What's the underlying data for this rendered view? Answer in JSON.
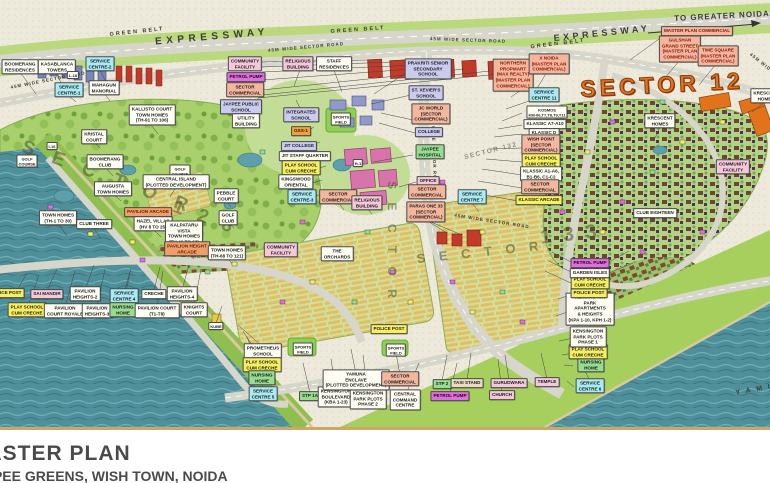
{
  "title": {
    "line1": "MASTER PLAN",
    "line2": "JAYPEE GREENS, WISH TOWN, NOIDA"
  },
  "palette": {
    "paper": "#eeeadb",
    "water": "#4e8f99",
    "golf_green": "#a9d06c",
    "road": "#d6d6ca",
    "green_belt": "#b9d97c",
    "commercial_orange": "#e0731c",
    "label_cyan": "#a9ebf4",
    "label_salmon": "#f4b79e",
    "label_yellow": "#f7f05e",
    "label_magenta": "#e06edd",
    "label_green": "#97dd90",
    "label_pink": "#f3c8da",
    "title_border": "#c9a86b"
  },
  "map": {
    "road_texts": [
      {
        "t": "EXPRESSWAY",
        "x": 212,
        "y": 37,
        "r": -5,
        "s": 10,
        "ls": 4.5
      },
      {
        "t": "EXPRESSWAY",
        "x": 602,
        "y": 33,
        "r": -6,
        "s": 9,
        "ls": 3.5
      },
      {
        "t": "GREEN BELT",
        "x": 137,
        "y": 32,
        "r": -6,
        "s": 5.5,
        "ls": 2
      },
      {
        "t": "GREEN BELT",
        "x": 358,
        "y": 30,
        "r": -4,
        "s": 5.5,
        "ls": 2
      },
      {
        "t": "GREEN BELT",
        "x": 558,
        "y": 44,
        "r": -7,
        "s": 5.5,
        "ls": 2
      },
      {
        "t": "45M WIDE SECTOR ROAD",
        "x": 48,
        "y": 80,
        "r": -11,
        "s": 4.5,
        "ls": 1
      },
      {
        "t": "45M WIDE SECTOR ROAD",
        "x": 306,
        "y": 47,
        "r": -5,
        "s": 4.5,
        "ls": 1
      },
      {
        "t": "45M WIDE SECTOR ROAD",
        "x": 468,
        "y": 40,
        "r": 2,
        "s": 4.5,
        "ls": 1
      },
      {
        "t": "45M WIDE SECTOR ROAD",
        "x": 492,
        "y": 221,
        "r": 9,
        "s": 4.5,
        "ls": 1
      },
      {
        "t": "45M WIDE SECTOR ROAD",
        "x": 434,
        "y": 150,
        "r": 88,
        "s": 4.5,
        "ls": 1
      },
      {
        "t": "45M WIDE",
        "x": 762,
        "y": 63,
        "r": 38,
        "s": 4.5,
        "ls": 1
      },
      {
        "t": "TO GREATER NOIDA",
        "x": 722,
        "y": 16,
        "r": -3,
        "s": 8,
        "ls": 1
      },
      {
        "t": "Y A M U N A",
        "x": 766,
        "y": 388,
        "r": -10,
        "s": 7,
        "ls": 2
      }
    ],
    "watermarks": [
      {
        "t": "S E C T O R",
        "x": 108,
        "y": 178,
        "r": 20,
        "s": 19,
        "ls": 7
      },
      {
        "t": "1 2 8",
        "x": 205,
        "y": 218,
        "r": 20,
        "s": 19,
        "ls": 5
      },
      {
        "t": "S E C T O R",
        "x": 480,
        "y": 252,
        "r": -6,
        "s": 13,
        "ls": 5
      },
      {
        "t": "1 3 3",
        "x": 570,
        "y": 235,
        "r": -6,
        "s": 20,
        "ls": 3
      },
      {
        "t": "S E C T O R",
        "x": 392,
        "y": 242,
        "r": 90,
        "s": 12,
        "ls": 5
      },
      {
        "t": "SECTOR 132",
        "x": 491,
        "y": 151,
        "r": -14,
        "s": 6.5,
        "ls": 1.5,
        "c": "light"
      },
      {
        "t": "SECTOR 12",
        "x": 662,
        "y": 85,
        "r": -3,
        "s": 23,
        "ls": 4,
        "c": "orangewm"
      }
    ],
    "labels": [
      {
        "t": "BOOMERANG\nRESIDENCES",
        "x": 20,
        "y": 67,
        "c": "white"
      },
      {
        "t": "KASABLANCA\nTOWERS",
        "x": 57,
        "y": 67,
        "c": "white"
      },
      {
        "t": "SERVICE\nCENTRE-2",
        "x": 100,
        "y": 64,
        "c": "cyan"
      },
      {
        "t": "SERVICE\nCENTRE-1",
        "x": 69,
        "y": 90,
        "c": "cyan"
      },
      {
        "t": "MAHAGUN\nMANORIAL",
        "x": 104,
        "y": 88,
        "c": "white"
      },
      {
        "t": "KALLISTO COURT\nTOWN HOMES\n(TH-91 TO 106)",
        "x": 152,
        "y": 115,
        "c": "white"
      },
      {
        "t": "KRISTAL\nCOURT",
        "x": 94,
        "y": 137,
        "c": "white"
      },
      {
        "t": "I-16",
        "x": 52,
        "y": 146,
        "c": "white tiny"
      },
      {
        "t": "L-18",
        "x": 73,
        "y": 75,
        "c": "white tiny"
      },
      {
        "t": "COMMUNITY\nFACILITY",
        "x": 245,
        "y": 64,
        "c": "pink"
      },
      {
        "t": "PETROL PUMP",
        "x": 246,
        "y": 77,
        "c": "magenta"
      },
      {
        "t": "SECTOR\nCOMMERCIAL",
        "x": 245,
        "y": 90,
        "c": "salmon"
      },
      {
        "t": "JAYPEE PUBLIC\nSCHOOL",
        "x": 241,
        "y": 107,
        "c": "lavender"
      },
      {
        "t": "UTILITY\nBUILDING",
        "x": 246,
        "y": 121,
        "c": "white"
      },
      {
        "t": "RELIGIOUS\nBUILDING",
        "x": 298,
        "y": 64,
        "c": "pink"
      },
      {
        "t": "STAFF\nRESIDENCES",
        "x": 334,
        "y": 64,
        "c": "white"
      },
      {
        "t": "INTEGRATED\nSCHOOL",
        "x": 301,
        "y": 115,
        "c": "lavender"
      },
      {
        "t": "GSS-1",
        "x": 301,
        "y": 131,
        "c": "orange"
      },
      {
        "t": "JIT COLLEGE",
        "x": 299,
        "y": 146,
        "c": "lavender"
      },
      {
        "t": "JIT STAFF QUARTER",
        "x": 305,
        "y": 156,
        "c": "white"
      },
      {
        "t": "PLAY SCHOOL\nCUM CRECHE",
        "x": 301,
        "y": 168,
        "c": "yellow"
      },
      {
        "t": "KINGSWOOD\nORIENTAL",
        "x": 296,
        "y": 182,
        "c": "white"
      },
      {
        "t": "SERVICE\nCENTRE-3",
        "x": 302,
        "y": 197,
        "c": "cyan"
      },
      {
        "t": "SECTOR\nCOMMERCIAL",
        "x": 338,
        "y": 197,
        "c": "salmon"
      },
      {
        "t": "RELIGIOUS\nBUILDING",
        "x": 367,
        "y": 203,
        "c": "pink"
      },
      {
        "t": "PRAKRITI SENIOR\nSECONDARY\nSCHOOL",
        "x": 428,
        "y": 69,
        "c": "lavender"
      },
      {
        "t": "ST. XEVIER'S\nSCHOOL",
        "x": 426,
        "y": 93,
        "c": "lavender"
      },
      {
        "t": "JC WORLD\n(SECTOR\nCOMMERCIAL)",
        "x": 431,
        "y": 114,
        "c": "salmon"
      },
      {
        "t": "COLLEGE",
        "x": 429,
        "y": 132,
        "c": "lavender"
      },
      {
        "t": "JAYPEE\nHOSPITAL",
        "x": 430,
        "y": 152,
        "c": "green"
      },
      {
        "t": "OFFICE",
        "x": 428,
        "y": 181,
        "c": "pink"
      },
      {
        "t": "SECTOR\nCOMMERCIAL",
        "x": 427,
        "y": 192,
        "c": "salmon"
      },
      {
        "t": "PARAS ONE 33\n(SECTOR\nCOMMERCIAL)",
        "x": 426,
        "y": 212,
        "c": "salmon"
      },
      {
        "t": "SERVICE\nCENTRE 7",
        "x": 472,
        "y": 197,
        "c": "cyan"
      },
      {
        "t": "SPORTS\nFIELD",
        "x": 341,
        "y": 119,
        "c": "white tiny"
      },
      {
        "t": "SPORTS\nFIELD",
        "x": 303,
        "y": 349,
        "c": "white tiny"
      },
      {
        "t": "SPORTS\nFIELD",
        "x": 396,
        "y": 350,
        "c": "white tiny"
      },
      {
        "t": "H-1",
        "x": 358,
        "y": 163,
        "c": "white tiny"
      },
      {
        "t": "NORTHERN\nPROPMART\n(MAX REALTY)\n(MASTER PLAN\nCOMMERCIAL)",
        "x": 513,
        "y": 75,
        "c": "redtext"
      },
      {
        "t": "X NOIDA\n(MASTER PLAN\nCOMMERCIAL)",
        "x": 549,
        "y": 64,
        "c": "redtext"
      },
      {
        "t": "SERVICE\nCENTRE 11",
        "x": 544,
        "y": 95,
        "c": "cyan"
      },
      {
        "t": "KOSMOS\nKM-06,T7,T8,T9,T11",
        "x": 547,
        "y": 112,
        "c": "white tiny"
      },
      {
        "t": "KLASSIC A7-A10",
        "x": 545,
        "y": 124,
        "c": "white"
      },
      {
        "t": "KLASSIC D",
        "x": 544,
        "y": 133,
        "c": "white"
      },
      {
        "t": "WISH POINT\n(SECTOR\nCOMMERCIAL)",
        "x": 541,
        "y": 145,
        "c": "salmon"
      },
      {
        "t": "PLAY SCHOOL\nCUM CRECHE",
        "x": 541,
        "y": 161,
        "c": "yellow"
      },
      {
        "t": "KLASSIC A1-A6,\nB1-B6, C1-C2",
        "x": 541,
        "y": 174,
        "c": "white"
      },
      {
        "t": "SECTOR\nCOMMERCIAL",
        "x": 540,
        "y": 187,
        "c": "salmon"
      },
      {
        "t": "KLASSIC ARCADE",
        "x": 539,
        "y": 200,
        "c": "yellow"
      },
      {
        "t": "MASTER PLAN COMMERCIAL",
        "x": 697,
        "y": 31,
        "c": "redtext"
      },
      {
        "t": "GULSHAN\nGRAND STREET\n(MASTER PLAN\nCOMMERCIAL)",
        "x": 680,
        "y": 49,
        "c": "redtext"
      },
      {
        "t": "TIME SQUARE\n(MASTER PLAN\nCOMMERCIAL)",
        "x": 718,
        "y": 56,
        "c": "redtext"
      },
      {
        "t": "KRESCENT\nHOMES",
        "x": 660,
        "y": 121,
        "c": "white"
      },
      {
        "t": "KRESCENT\nHOMES",
        "x": 766,
        "y": 96,
        "c": "white"
      },
      {
        "t": "COMMUNITY\nFACILITY",
        "x": 733,
        "y": 167,
        "c": "pink"
      },
      {
        "t": "CLUB EIGHTEEN",
        "x": 655,
        "y": 213,
        "c": "white"
      },
      {
        "t": "COMMUNITY\nFACILITY",
        "x": 281,
        "y": 250,
        "c": "pink"
      },
      {
        "t": "THE\nORCHARDS",
        "x": 337,
        "y": 254,
        "c": "white"
      },
      {
        "t": "GOLF\nCOURSE",
        "x": 27,
        "y": 161,
        "c": "white tiny"
      },
      {
        "t": "GOLF\nCOURSE",
        "x": 180,
        "y": 171,
        "c": "white tiny"
      },
      {
        "t": "BOOMERANG\nCLUB",
        "x": 105,
        "y": 162,
        "c": "white"
      },
      {
        "t": "AUGUSTA\nTOWN HOMES",
        "x": 113,
        "y": 189,
        "c": "white"
      },
      {
        "t": "CENTRAL ISLAND\n(PLOTTED DEVELOPMENT)",
        "x": 176,
        "y": 182,
        "c": "white"
      },
      {
        "t": "PEBBLE\nCOURT",
        "x": 226,
        "y": 196,
        "c": "white"
      },
      {
        "t": "GOLF\nCLUB",
        "x": 228,
        "y": 218,
        "c": "white"
      },
      {
        "t": "TOWN HOMES\n(TH-1 TO 30)",
        "x": 58,
        "y": 218,
        "c": "white"
      },
      {
        "t": "CLUB THREE",
        "x": 94,
        "y": 224,
        "c": "white"
      },
      {
        "t": "PAVILION ARCADE",
        "x": 148,
        "y": 212,
        "c": "orangebrown"
      },
      {
        "t": "HAZEL VILLAS\n(HV 8 TO 25)",
        "x": 153,
        "y": 224,
        "c": "white"
      },
      {
        "t": "KALPATARU\nVISTA\nTOWN HOMES\n(TH-46 TO 63)",
        "x": 184,
        "y": 234,
        "c": "white"
      },
      {
        "t": "PAVILION HEIGHT\nARCADE",
        "x": 187,
        "y": 249,
        "c": "orangebrown"
      },
      {
        "t": "TOWN HOMES\n(TH-68 TO 121)",
        "x": 227,
        "y": 253,
        "c": "white"
      },
      {
        "t": "POLICE POST",
        "x": 6,
        "y": 293,
        "c": "yellow"
      },
      {
        "t": "SAI MANDIR",
        "x": 47,
        "y": 294,
        "c": "pink"
      },
      {
        "t": "PAVILION\nHEIGHTS-2",
        "x": 85,
        "y": 294,
        "c": "white"
      },
      {
        "t": "SERVICE\nCENTRE 4",
        "x": 124,
        "y": 296,
        "c": "cyan"
      },
      {
        "t": "CRECHE",
        "x": 154,
        "y": 294,
        "c": "white"
      },
      {
        "t": "PAVILION\nHEIGHTS-4",
        "x": 182,
        "y": 294,
        "c": "white"
      },
      {
        "t": "PLAY SCHOOL\nCUM CRECHE",
        "x": 27,
        "y": 310,
        "c": "yellow"
      },
      {
        "t": "PAVILION\nCOURT ROYALE",
        "x": 65,
        "y": 311,
        "c": "white"
      },
      {
        "t": "PAVILION\nHEIGHTS-3",
        "x": 97,
        "y": 311,
        "c": "white"
      },
      {
        "t": "NURSING\nHOME",
        "x": 123,
        "y": 310,
        "c": "green"
      },
      {
        "t": "PAVILION COURT\n(T1-T8)",
        "x": 157,
        "y": 311,
        "c": "white"
      },
      {
        "t": "KNIGHTS\nCOURT",
        "x": 194,
        "y": 310,
        "c": "white"
      },
      {
        "t": "KUBE",
        "x": 216,
        "y": 326,
        "c": "white tiny"
      },
      {
        "t": "PROMETHEUS\nSCHOOL",
        "x": 263,
        "y": 351,
        "c": "white"
      },
      {
        "t": "PLAY SCHOOL\nCUM CRECHE",
        "x": 262,
        "y": 365,
        "c": "yellow"
      },
      {
        "t": "NURSING\nHOME",
        "x": 262,
        "y": 378,
        "c": "green"
      },
      {
        "t": "SERVICE\nCENTRE 5",
        "x": 263,
        "y": 394,
        "c": "cyan"
      },
      {
        "t": "STP 1A",
        "x": 310,
        "y": 396,
        "c": "green"
      },
      {
        "t": "KENSINGTON\nBOULEVARD\n(KBA 1-23)",
        "x": 336,
        "y": 397,
        "c": "white"
      },
      {
        "t": "KENSINGTON\nPARK PLOTS\nPHASE 2",
        "x": 368,
        "y": 399,
        "c": "white"
      },
      {
        "t": "YAMUNA\nENCLAVE\n(PLOTTED DEVELOPMENT)",
        "x": 356,
        "y": 380,
        "c": "white"
      },
      {
        "t": "SECTOR\nCOMMERCIAL",
        "x": 400,
        "y": 379,
        "c": "salmon"
      },
      {
        "t": "CENTRAL\nCOMMAND\nCENTRE",
        "x": 405,
        "y": 400,
        "c": "white"
      },
      {
        "t": "STP 2",
        "x": 442,
        "y": 384,
        "c": "green"
      },
      {
        "t": "TAXI STAND",
        "x": 467,
        "y": 383,
        "c": "tan"
      },
      {
        "t": "PETROL PUMP",
        "x": 450,
        "y": 396,
        "c": "magenta"
      },
      {
        "t": "GURUDWARA",
        "x": 509,
        "y": 383,
        "c": "pink"
      },
      {
        "t": "CHURCH",
        "x": 502,
        "y": 395,
        "c": "pink"
      },
      {
        "t": "TEMPLE",
        "x": 547,
        "y": 382,
        "c": "pink"
      },
      {
        "t": "SERVICE\nCENTRE 6",
        "x": 590,
        "y": 386,
        "c": "cyan"
      },
      {
        "t": "NURSING\nHOME",
        "x": 591,
        "y": 365,
        "c": "green"
      },
      {
        "t": "PLAY SCHOOL\nCUM CRECHE",
        "x": 588,
        "y": 352,
        "c": "yellow"
      },
      {
        "t": "KENSINGTON\nPARK PLOTS\nPHASE 1",
        "x": 588,
        "y": 337,
        "c": "white"
      },
      {
        "t": "KENSINGTON\nPARK\nAPARTMENTS\n& HEIGHTS\n(KPA 1-10, KPH 1-2)",
        "x": 590,
        "y": 309,
        "c": "white"
      },
      {
        "t": "POLICE POST",
        "x": 589,
        "y": 293,
        "c": "yellow"
      },
      {
        "t": "PLAY SCHOOL\nCUM CRECHE",
        "x": 590,
        "y": 282,
        "c": "yellow"
      },
      {
        "t": "GARDEN ISLES",
        "x": 590,
        "y": 273,
        "c": "white"
      },
      {
        "t": "PETROL PUMP",
        "x": 590,
        "y": 263,
        "c": "magenta"
      },
      {
        "t": "POLICE POST",
        "x": 389,
        "y": 329,
        "c": "yellow"
      }
    ]
  }
}
